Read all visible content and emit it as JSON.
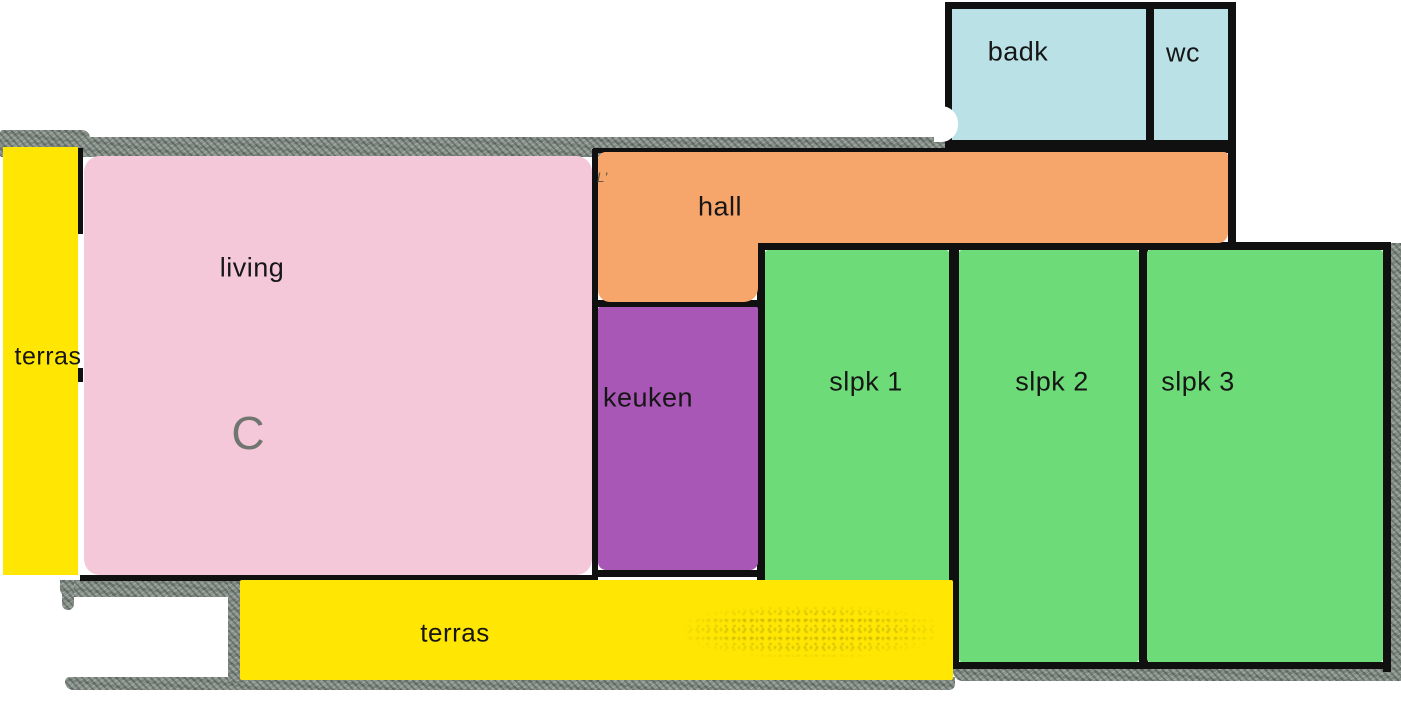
{
  "figure": {
    "type": "floor-plan",
    "description_labels_visible_only": true
  },
  "rooms": [
    {
      "key": "terras_left",
      "label": "terras",
      "color_key": "yellow"
    },
    {
      "key": "living",
      "label": "living",
      "color_key": "pink"
    },
    {
      "key": "hall",
      "label": "hall",
      "color_key": "orange"
    },
    {
      "key": "keuken",
      "label": "keuken",
      "color_key": "purple"
    },
    {
      "key": "slpk1",
      "label": "slpk 1",
      "color_key": "green"
    },
    {
      "key": "slpk2",
      "label": "slpk 2",
      "color_key": "green"
    },
    {
      "key": "slpk3",
      "label": "slpk 3",
      "color_key": "green"
    },
    {
      "key": "badk",
      "label": "badk",
      "color_key": "blue"
    },
    {
      "key": "wc",
      "label": "wc",
      "color_key": "blue"
    },
    {
      "key": "terras_bottom",
      "label": "terras",
      "color_key": "yellow"
    }
  ],
  "annotations": {
    "room_mark": "C",
    "corner_mark": "L'"
  },
  "colors": {
    "yellow": "#FFE603",
    "pink": "#F4C8D8",
    "orange": "#F6A56B",
    "purple": "#A957B6",
    "green": "#6DDB78",
    "blue": "#BAE2E6",
    "wall": "#8C958D",
    "line": "#101010",
    "mark": "#5A675E"
  }
}
